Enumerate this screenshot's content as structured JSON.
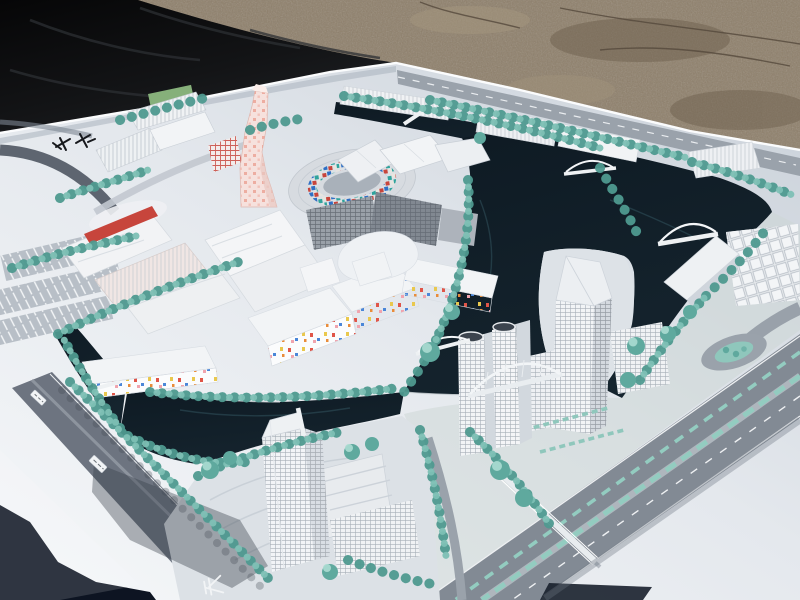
{
  "image": {
    "kind": "photograph",
    "subject": "Architectural scale model of a canal-laced urban district photographed at an angle outdoors",
    "width_px": 800,
    "height_px": 600
  },
  "palette": {
    "gravel": "#8e7f6a",
    "gravel_dark": "#6f614f",
    "gravel_light": "#a5977f",
    "tarp": "#0b0c0e",
    "tarp_fold": "#2c2f33",
    "board": "#e9edf1",
    "board_shade": "#ccd3db",
    "board_bright": "#f6f8fa",
    "water": "#101c26",
    "water_edge": "#27434c",
    "tree_dark": "#4f9a90",
    "tree": "#7ec0b5",
    "tree_light": "#abdbd2",
    "road": "#828a94",
    "road_light": "#9aa2ab",
    "road_dark": "#6d7480",
    "building_white": "#f1f3f5",
    "building_shade": "#ccd2da",
    "dark_glass": "#818891",
    "pink_tower": "#f6e1dd",
    "pink_dot": "#eba496",
    "accent_red": "#c7453c",
    "mosaic_blue": "#2f6fc4",
    "mosaic_teal": "#2fa39c",
    "confetti_yellow": "#e9c84e",
    "confetti_pink": "#f0a4ae",
    "corner_dark": "#0d1422"
  },
  "markings": {
    "road_glyph": "天",
    "corner_inscription": "✕✕",
    "name_plate_count": 2
  },
  "inventory": [
    "gravel ground strip at top",
    "black tarp cover at top-left",
    "white model baseboard in perspective",
    "dark canals and lake winding through the district",
    "ring-shaped courtyard building with colored mosaic facade",
    "twisted pink polka-dot tower",
    "retail complex with wavy roofs and red accent stripe",
    "sawtooth-roof block rows along the north canal",
    "white high-rise tower with angled crown",
    "twin towers with dark oval roof courts",
    "gridded slab office buildings",
    "cluster of small white housing cubes at right",
    "confetti-dotted low-rise buildings",
    "south tower with stepped podium",
    "arched pedestrian bridges over canals",
    "tree-lined streets with teal model trees",
    "parking lots with white stall stripes",
    "wide arterial road with teal medians, ramp and roundabout",
    "footbridge across the arterial",
    "white road name plates and painted road glyph",
    "black inscription marks on the board corner"
  ]
}
